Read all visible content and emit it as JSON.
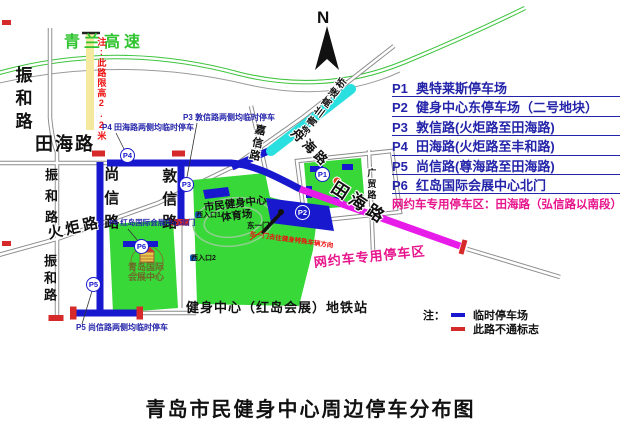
{
  "title": "青岛市民健身中心周边停车分布图",
  "compass": {
    "label": "N"
  },
  "legend": {
    "items": [
      {
        "code": "P1",
        "desc": "奥特莱斯停车场"
      },
      {
        "code": "P2",
        "desc": "健身中心东停车场（二号地块）"
      },
      {
        "code": "P3",
        "desc": "敦信路(火炬路至田海路)"
      },
      {
        "code": "P4",
        "desc": "田海路(火炬路至丰和路)"
      },
      {
        "code": "P5",
        "desc": "尚信路(尊海路至田海路)"
      },
      {
        "code": "P6",
        "desc": "红岛国际会展中心北门"
      }
    ],
    "reserved": "网约车专用停车区：田海路（弘信路以南段）"
  },
  "notes": {
    "prefix": "注：",
    "temp": "临时停车场",
    "closed": "此路不通标志"
  },
  "map": {
    "labels": {
      "expressway": "青兰高速",
      "zhenhe1": "振和路",
      "zhenhe2": "振和路",
      "zhenhe3": "振和路",
      "tianhai_w": "田海路",
      "tianhai_se": "田海路",
      "shangxin": "尚信路",
      "dunxin": "敦信路",
      "jiaxin": "嘉信路",
      "huoju": "火炬路",
      "zhouhai": "舟海路",
      "guangmao": "广贸路",
      "bridge": "跨青兰高速桥",
      "height_limit": "注:此路限高2.2米",
      "stadium1": "市民健身中心",
      "stadium2": "体育场",
      "expo1": "青岛国际",
      "expo2": "会展中心",
      "metro": "健身中心（红岛会展）地铁站",
      "entrance1": "西入口1",
      "entrance2": "西入口2",
      "east_gate": "东一门",
      "east_gate_note": "东一门去往健身特殊车辆方向",
      "p3_note": "P3 敦信路两侧均临时停车",
      "p4_note": "P4 田海路两侧均临时停车",
      "p5_note": "P5 尚信路两侧均临时停车",
      "p6_note": "P6 红岛国际会展中心北门",
      "ride_zone": "网约车专用停车区"
    },
    "markers": {
      "p1": "P1",
      "p2": "P2",
      "p3": "P3",
      "p4": "P4",
      "p5": "P5",
      "p6": "P6"
    }
  },
  "colors": {
    "road_blue": "#1818cf",
    "closed_red": "#d62a2a",
    "area_green": "#38d838",
    "expressway_green": "#3ec43e",
    "bridge_cyan": "#2adfdf",
    "ride_zone_magenta": "#e81ce8",
    "legend_navy": "#2424aa",
    "note_pink": "#e8148c",
    "height_limit_yellow": "#f5e9a0"
  }
}
